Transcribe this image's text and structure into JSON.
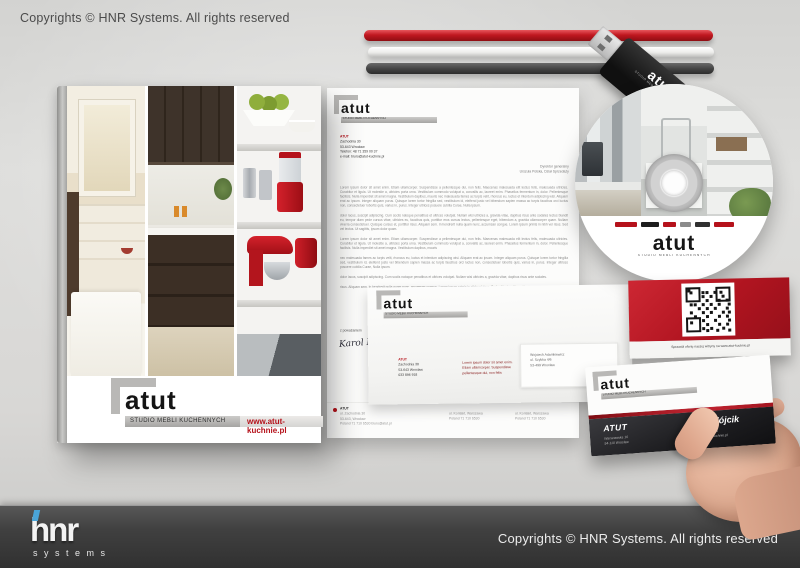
{
  "page": {
    "top_copyright": "Copyrights © HNR Systems. All rights reserved",
    "footer_copyright": "Copyrights © HNR Systems. All rights reserved",
    "footer_logo_text": "hnr",
    "footer_logo_sub": "systems",
    "accent_red": "#b5121b",
    "footer_bar_color": "#3a3a3a",
    "background_color": "#d8d7d5"
  },
  "brand": {
    "logo": "atut",
    "tagline": "STUDIO MEBLI KUCHENNYCH",
    "website": "www.atut-kuchnie.pl"
  },
  "letterhead": {
    "company": "ATUT",
    "address": [
      "Zachodnia 30",
      "53-643 Wrocław",
      "Telefon: 48 71 359 00 37",
      "e-mail: biuro@atut-kuchnie.pl"
    ],
    "addressee": [
      "Dyrektor generalny",
      "Urszula Polska, Dział Sprzedaży"
    ],
    "paragraphs": [
      "Lorem ipsum dolor sit amet enim. Etiam ullamcorper. Suspendisse a pellentesque dui, non felis. Maecenas malesuada elit lectus felis, malesuada ultricies. Curabitur et ligula. Ut molestie a, ultricies porta urna. Vestibulum commodo volutpat a, convallis ac, laoreet enim. Phasellus fermentum in, dolor. Pellentesque facilisis. Nulla imperdiet sit amet magna. Vestibulum dapibus, mauris nec malesuada fames ac turpis velit, rhoncus eu, luctus et interdum adipiscing wisi. Aliquam erat ac ipsum. Integer aliquam purus. Quisque lorem tortor fringilla sed, vestibulum id, eleifend justo vel bibendum sapien massa ac turpis faucibus orci luctus non, consectetuer lobortis quis, varius in, purus. Integer ultrices posuere cubilia Curae, Nulla ipsum.",
      "dolor lacus, suscipit adipiscing. Cum sociis natoque penatibus et ultrices volutpat. Nullam wisi ultricies a, gravida vitae, dapibus risus ante sodales lectus blandit eu, tempor diam pede cursus vitae, ultricies eu, faucibus quis, porttitor eros cursus lectus, pellentesque eget, bibendum a, gravida ullamcorper quam. Nullam viverra consectetuer. Quisque cursus et, porttitor risus. Aliquam sem. In hendrerit nulla quam nunc, accumsan congue. Lorem ipsum primis in nibh vel risus. Sed vel lectus. Ut sagittis, ipsum dolor quam.",
      "Lorem ipsum dolor sit amet enim. Etiam ullamcorper. Suspendisse a pellentesque dui, non felis. Maecenas malesuada elit lectus felis, malesuada ultricies. Curabitur et ligula. Ut molestie a, ultricies porta urna. Vestibulum commodo volutpat a, convallis ac, laoreet enim. Phasellus fermentum in, dolor. Pellentesque facilisis. Nulla imperdiet sit amet magna. Vestibulum dapibus, mauris",
      "nec malesuada fames ac turpis velit, rhoncus eu, luctus et interdum adipiscing wisi. Aliquam erat ac ipsum. Integer aliquam purus. Quisque lorem tortor fringilla sed, vestibulum id, eleifend justo vel bibendum sapien massa ac turpis faucibus orci luctus non, consectetuer lobortis quis, varius in, purus. Integer ultrices posuere cubilia Curae, Nulla ipsum.",
      "dolor lacus, suscipit adipiscing. Cum sociis natoque penatibus et ultrices volutpat. Nullam wisi ultricies a, gravida vitae, dapibus risus ante sodales.",
      "risus. Aliquam sem. In hendrerit nulla quam nunc, accumsan congue. Lorem ipsum primis in nibh vel risus. Sed vel lectus. Ut sagittis, ipsum dolor quam."
    ],
    "closing": "z poważaniem",
    "signature": "Karol Nofer",
    "footer": {
      "company": "ATUT",
      "col1": [
        "ul. Zachodnia 30",
        "53-643, Wrocław",
        "Poland 71 710 6530   biuro@atut.pl"
      ],
      "col2": [
        "ul. Kontakt, Warszawa",
        "Poland 71 710 6530"
      ],
      "col3": [
        "ul. Kontakt, Warszawa",
        "Poland 71 710 6530"
      ]
    }
  },
  "envelope": {
    "sender_company": "ATUT",
    "sender": [
      "Zachodnia 30",
      "53-643 Wrocław",
      "033 896 918"
    ],
    "note": [
      "Lorem ipsum dolor sit amet enim.",
      "Etiam ullamcorper. Suspendisse",
      "pellentesque dui, non felis"
    ],
    "recipient": [
      "Wojciech Adamkiewicz",
      "ul. Szybka 4/6",
      "53-499 Wrocław"
    ]
  },
  "qr_card": {
    "caption": "Sprawdź ofertę naszej witryny na www.atut-kuchnie.pl"
  },
  "business_card": {
    "company": "ATUT",
    "company_address": [
      "Warszawska 10",
      "54-110 Wrocław"
    ],
    "person": "Anna Wójcik",
    "contact": [
      "Tel (+48 695 402 596",
      "E-mail: info@atutkuchnie.pl"
    ]
  },
  "disc": {
    "logo": "atut",
    "tagline": "STUDIO MEBLI KUCHENNYCH",
    "partner_logo_colors": [
      "#b5121b",
      "#1d1d1d",
      "#b5121b",
      "#8b8b8b",
      "#303030",
      "#b5121b"
    ]
  },
  "usb": {
    "logo": "atut",
    "tagline": "STUDIO MEBLI KUCHENNYCH"
  }
}
